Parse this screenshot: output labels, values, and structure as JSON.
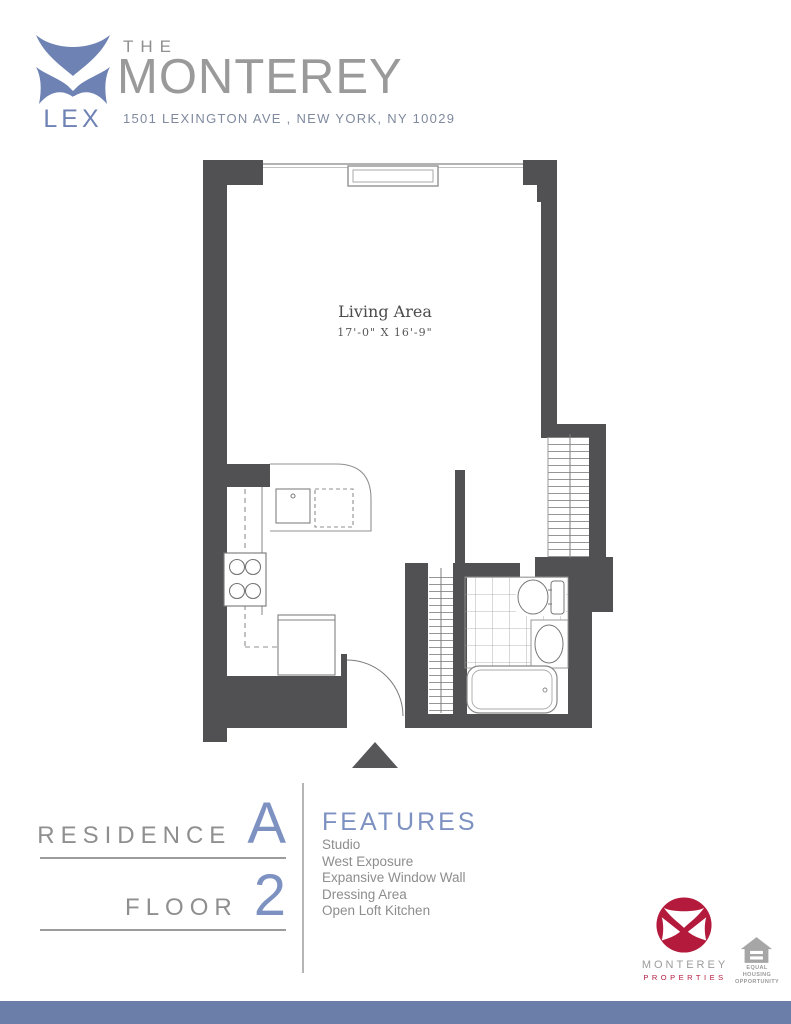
{
  "header": {
    "brand_small": "THE",
    "brand_large": "MONTEREY",
    "address": "1501 LEXINGTON AVE , NEW YORK, NY 10029",
    "logo": {
      "at": "AT",
      "lex": "LEX"
    }
  },
  "plan": {
    "room_label": "Living Area",
    "room_dimensions": "17'-0\" X 16'-9\""
  },
  "residence": {
    "label": "RESIDENCE",
    "value": "A"
  },
  "floor": {
    "label": "FLOOR",
    "value": "2"
  },
  "features": {
    "heading": "FEATURES",
    "items": [
      "Studio",
      "West Exposure",
      "Expansive Window Wall",
      "Dressing Area",
      "Open Loft Kitchen"
    ]
  },
  "footer": {
    "properties_name": "MONTEREY",
    "properties_sub": "PROPERTIES",
    "equal_housing_line1": "EQUAL HOUSING",
    "equal_housing_line2": "OPPORTUNITY"
  },
  "colors": {
    "brand_blue": "#6e82b4",
    "accent_blue": "#7e92c2",
    "logo_red": "#b31a3c",
    "wall_gray": "#515153",
    "footer_bar_blue": "#6b7da9"
  }
}
